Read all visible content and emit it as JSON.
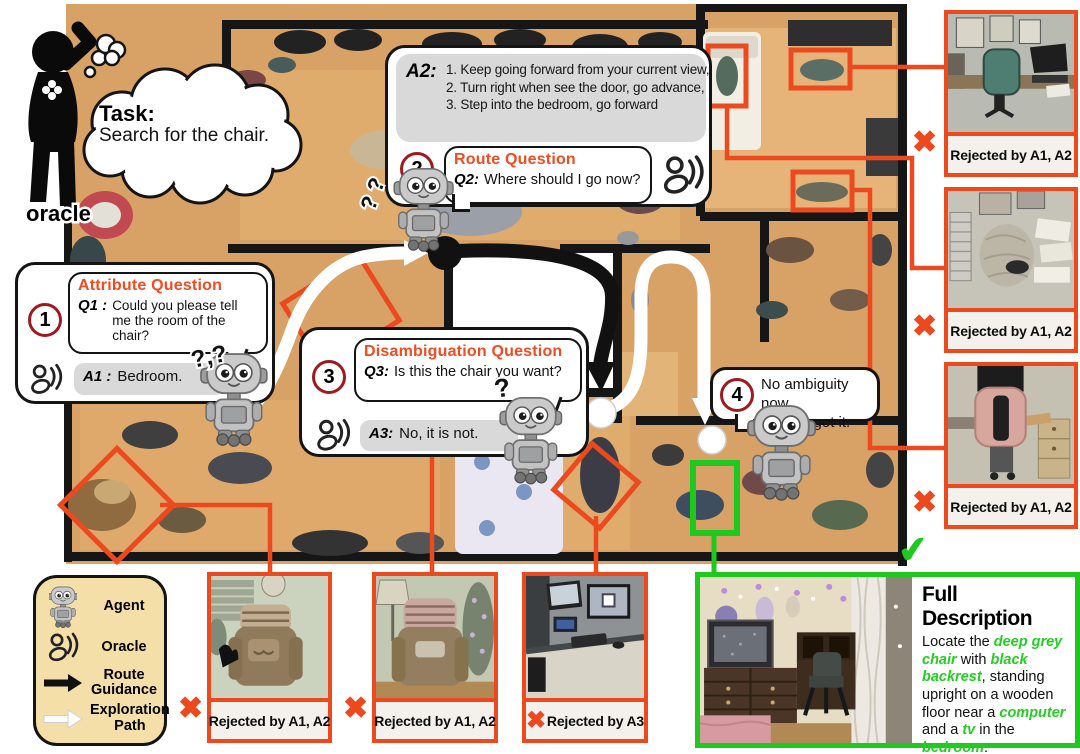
{
  "icons": {
    "reject_x": "✖",
    "check_mark": "✔"
  },
  "oracle_figure": {
    "label": "oracle"
  },
  "task_bubble": {
    "title": "Task:",
    "text": "Search for the chair."
  },
  "dialog1": {
    "badge": "1",
    "title": "Attribute Question",
    "q_label": "Q1 :",
    "q_text": "Could you please tell me the room of the chair?",
    "a_label": "A1 :",
    "a_text": "Bedroom."
  },
  "dialog2": {
    "badge": "2",
    "title": "Route Question",
    "q_label": "Q2:",
    "q_text": "Where should I go now?",
    "a_label": "A2:",
    "a_line1": "1. Keep going forward from your current view,",
    "a_line2": "2. Turn right when see the door, go advance,",
    "a_line3": "3. Step into the bedroom, go forward"
  },
  "dialog3": {
    "badge": "3",
    "title": "Disambiguation Question",
    "q_label": "Q3:",
    "q_text": "Is this the chair you want?",
    "a_label": "A3:",
    "a_text": "No, it is not."
  },
  "dialog4": {
    "badge": "4",
    "line1": "No ambiguity now,",
    "line2": "I think I got it."
  },
  "robot_marks": {
    "robot1": "?,?",
    "robot2": "? ?",
    "robot3": "?"
  },
  "legend": {
    "agent": "Agent",
    "oracle": "Oracle",
    "route": "Route Guidance",
    "path": "Exploration Path"
  },
  "right_cards": {
    "c1": "Rejected by A1, A2",
    "c2": "Rejected by A1, A2",
    "c3": "Rejected by A1, A2"
  },
  "bottom_cards": {
    "c1": "Rejected by A1, A2",
    "c2": "Rejected by A1, A2",
    "c3": "Rejected by A3"
  },
  "full_description": {
    "title": "Full Description",
    "seg0": "Locate the ",
    "seg1": "deep grey chair",
    "seg2": " with ",
    "seg3": "black backrest",
    "seg4": ", standing upright on a wooden floor near a ",
    "seg5": "computer",
    "seg6": " and a ",
    "seg7": "tv",
    "seg8": " in the ",
    "seg9": "bedroom",
    "seg10": "."
  }
}
